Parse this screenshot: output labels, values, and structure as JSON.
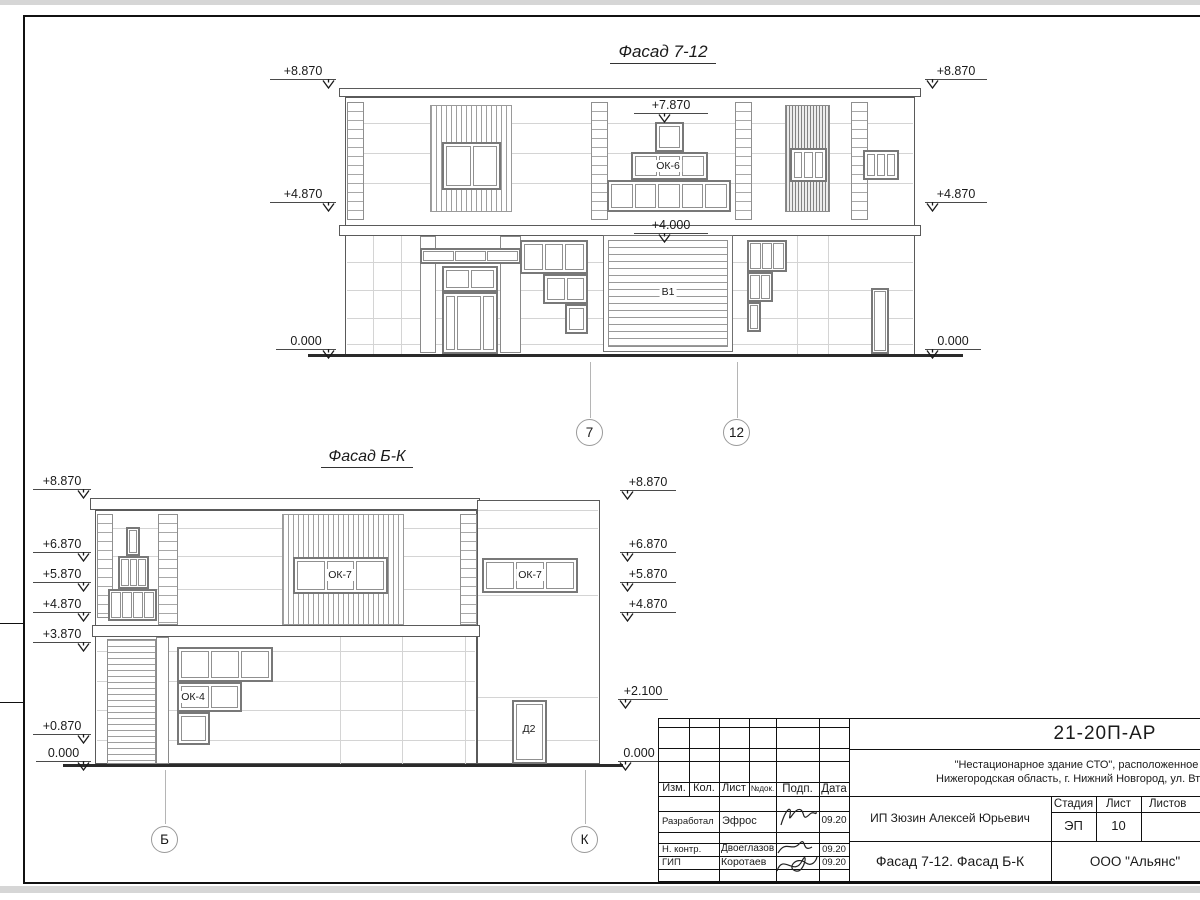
{
  "colors": {
    "line": "#5a5a5a",
    "frame": "#111111",
    "joint": "#d4d4d4"
  },
  "top_facade": {
    "title": "Фасад 7-12",
    "marks_left": [
      "+8.870",
      "+4.870",
      "0.000"
    ],
    "marks_right": [
      "+8.870",
      "+4.870",
      "0.000"
    ],
    "mark_window_top": "+7.870",
    "mark_gate_top": "+4.000",
    "window_label": "ОК-6",
    "gate_label": "В1",
    "axes": [
      "7",
      "12"
    ]
  },
  "bottom_facade": {
    "title": "Фасад Б-К",
    "marks_left": [
      "+8.870",
      "+6.870",
      "+5.870",
      "+4.870",
      "+3.870",
      "+0.870",
      "0.000"
    ],
    "marks_right": [
      "+8.870",
      "+6.870",
      "+5.870",
      "+4.870",
      "+2.100",
      "0.000"
    ],
    "window_label_left": "ОК-7",
    "window_label_right": "ОК-7",
    "window_label_ok4": "ОК-4",
    "door_label": "Д2",
    "axes": [
      "Б",
      "К"
    ]
  },
  "title_block": {
    "doc_number": "21-20П-АР",
    "project_line1": "\"Нестационарное здание СТО\", расположенное по адресу:",
    "project_line2": "Нижегородская область, г. Нижний Новгород, ул. Вторчермета, 1А",
    "columns": [
      "Изм.",
      "Кол.",
      "Лист",
      "№док.",
      "Подп.",
      "Дата"
    ],
    "rows": [
      {
        "role": "Разработал",
        "name": "Эфрос",
        "date": "09.20"
      },
      {
        "role": "Н. контр.",
        "name": "Двоеглазов",
        "date": "09.20"
      },
      {
        "role": "ГИП",
        "name": "Коротаев",
        "date": "09.20"
      }
    ],
    "client": "ИП Зюзин Алексей Юрьевич",
    "stage_cols": [
      "Стадия",
      "Лист",
      "Листов"
    ],
    "stage_value": "ЭП",
    "sheet_value": "10",
    "sheet_title": "Фасад 7-12. Фасад Б-К",
    "company": "ООО \"Альянс\""
  }
}
